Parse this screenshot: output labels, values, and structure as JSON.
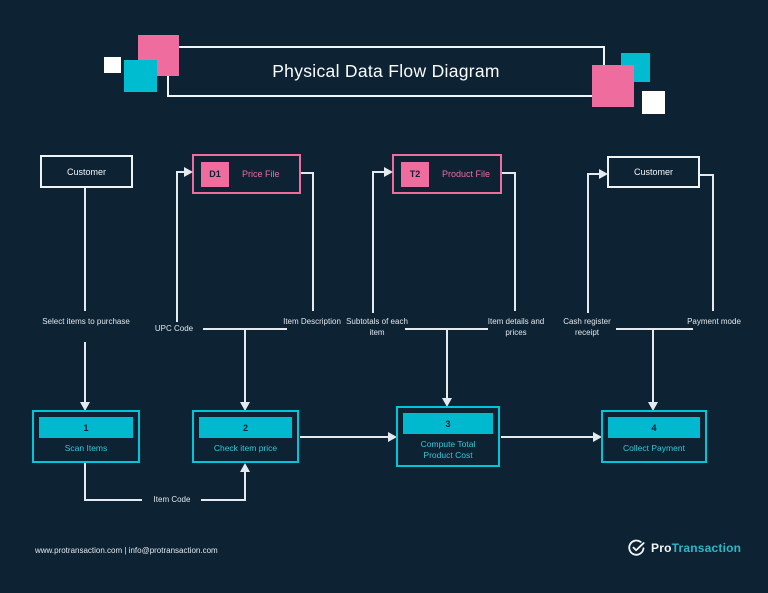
{
  "title": {
    "text": "Physical Data Flow Diagram"
  },
  "palette": {
    "background": "#0d2233",
    "pink": "#ee6d9e",
    "teal": "#00bcd1",
    "process_border": "#00c6d8",
    "process_fill": "#00b9cf",
    "process_text": "#2ecadb",
    "connector_line": "#e4eaee",
    "text_light": "#f3f6f8"
  },
  "entities": {
    "customer_left": {
      "label": "Customer"
    },
    "customer_right": {
      "label": "Customer"
    }
  },
  "data_stores": [
    {
      "id": "D1",
      "label": "Price File"
    },
    {
      "id": "T2",
      "label": "Product File"
    }
  ],
  "processes": [
    {
      "num": "1",
      "label": "Scan Items"
    },
    {
      "num": "2",
      "label": "Check item price"
    },
    {
      "num": "3",
      "label": "Compute Total Product Cost"
    },
    {
      "num": "4",
      "label": "Collect Payment"
    }
  ],
  "flow_labels": {
    "select_items": "Select items to purchase",
    "upc_code": "UPC Code",
    "item_description": "Item Description",
    "subtotals": "Subtotals of each item",
    "item_details": "Item details and prices",
    "cash_register": "Cash register receipt",
    "payment_mode": "Payment mode",
    "item_code": "Item Code"
  },
  "footer": {
    "contact": "www.protransaction.com | info@protransaction.com",
    "brand": {
      "pro": "Pro",
      "transaction": "Transaction"
    }
  }
}
